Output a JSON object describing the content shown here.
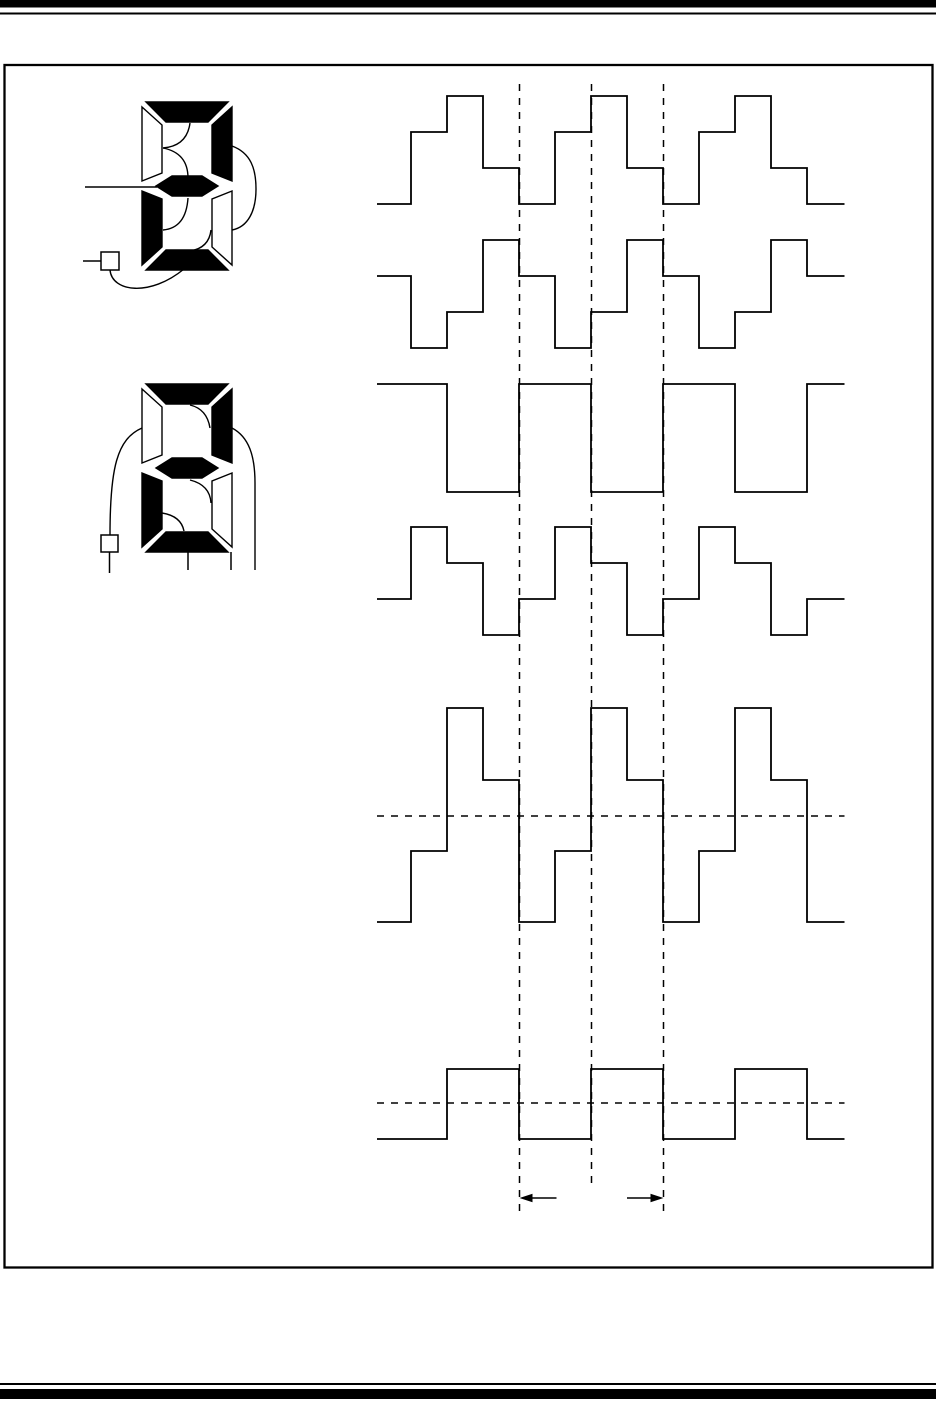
{
  "page": {
    "width": 936,
    "height": 1412,
    "paper_color": "#ffffff",
    "ink_color": "#000000"
  },
  "page_rules": {
    "top_thick_bar": {
      "x": 0,
      "y": 0,
      "w": 936,
      "h": 7.5
    },
    "top_thin_line": {
      "x": 0,
      "y": 12.5,
      "w": 936,
      "h": 2
    },
    "frame": {
      "x": 4.5,
      "y": 65,
      "w": 928,
      "h": 1202.5,
      "stroke_width": 2.3
    },
    "bottom_thin_line": {
      "x": 0,
      "y": 1383,
      "w": 936,
      "h": 2
    },
    "bottom_thick_bar": {
      "x": 0,
      "y": 1389,
      "w": 936,
      "h": 10
    }
  },
  "figure": {
    "displays": [
      {
        "name": "seven-segment-display-top",
        "x": 142,
        "y": 102,
        "w": 90,
        "h": 168,
        "digit_shown": "2",
        "on_segments": [
          "a",
          "b",
          "g",
          "e",
          "d"
        ],
        "off_segments": [
          "f",
          "c"
        ],
        "wires": [
          {
            "name": "wire-a-to-f",
            "d": "M 190 123 Q 187 146 163 148"
          },
          {
            "name": "wire-f-to-g",
            "d": "M 163 148 Q 188 153 188 178"
          },
          {
            "name": "wire-g-to-e",
            "d": "M 188 198 Q 186 228 163 230"
          },
          {
            "name": "wire-c-to-d",
            "d": "M 211 230 Q 209 248 190 251"
          },
          {
            "name": "wire-b-to-c",
            "d": "M 232 146 C 251 153 256 169 256 189 C 256 211 248 227 232 230"
          },
          {
            "name": "wire-square-to-d",
            "d": "M 110 270 C 112 292 150 297 184 269"
          }
        ],
        "leads": [
          {
            "name": "lead-to-segment-g",
            "x1": 85,
            "y1": 187,
            "x2": 157,
            "y2": 187
          },
          {
            "name": "lead-to-terminal",
            "x1": 83,
            "y1": 261,
            "x2": 101,
            "y2": 261
          }
        ],
        "terminal_square": {
          "x": 101,
          "y": 252,
          "w": 18,
          "h": 18
        },
        "drop_lines": []
      },
      {
        "name": "seven-segment-display-bottom",
        "x": 142,
        "y": 384,
        "w": 90,
        "h": 168,
        "digit_shown": "2",
        "on_segments": [
          "a",
          "b",
          "g",
          "e",
          "d"
        ],
        "off_segments": [
          "f",
          "c"
        ],
        "wires": [
          {
            "name": "wire-a-to-b",
            "d": "M 190 405 Q 207 409 210 428"
          },
          {
            "name": "wire-g-to-c",
            "d": "M 190 480 Q 210 485 211 503"
          },
          {
            "name": "wire-e-to-d",
            "d": "M 162 513 Q 181 516 184 531"
          },
          {
            "name": "wire-f-to-terminal",
            "d": "M 142 428 C 117 439 110 468 110 535"
          },
          {
            "name": "wire-b-down-right",
            "d": "M 232 428 C 249 437 255 456 255 483 L 255 570"
          }
        ],
        "leads": [],
        "terminal_square": {
          "x": 101,
          "y": 535,
          "w": 17,
          "h": 17
        },
        "drop_lines": [
          {
            "name": "terminal-drop-line",
            "x1": 109.5,
            "y1": 552,
            "x2": 109.5,
            "y2": 573
          },
          {
            "name": "segment-d-drop-line",
            "x1": 188,
            "y1": 552,
            "x2": 188,
            "y2": 570
          },
          {
            "name": "segment-c-drop-line",
            "x1": 231,
            "y1": 552,
            "x2": 231,
            "y2": 570
          }
        ]
      }
    ],
    "waveforms": [
      {
        "name": "waveform-1",
        "x_start": 377,
        "x_end": 844.5,
        "start": 0,
        "levels_y": [
          204,
          168,
          132,
          96
        ],
        "steps": [
          [
            411,
            2
          ],
          [
            447,
            3
          ],
          [
            483,
            1
          ],
          [
            519,
            0
          ],
          [
            555,
            2
          ],
          [
            591,
            3
          ],
          [
            627,
            1
          ],
          [
            663,
            0
          ],
          [
            699,
            2
          ],
          [
            735,
            3
          ],
          [
            771,
            1
          ],
          [
            807,
            0
          ]
        ]
      },
      {
        "name": "waveform-2",
        "x_start": 377,
        "x_end": 844.5,
        "start": 2,
        "levels_y": [
          348,
          312,
          276,
          240
        ],
        "steps": [
          [
            411,
            0
          ],
          [
            447,
            1
          ],
          [
            483,
            3
          ],
          [
            519,
            2
          ],
          [
            555,
            0
          ],
          [
            591,
            1
          ],
          [
            627,
            3
          ],
          [
            663,
            2
          ],
          [
            699,
            0
          ],
          [
            735,
            1
          ],
          [
            771,
            3
          ],
          [
            807,
            2
          ]
        ]
      },
      {
        "name": "waveform-3",
        "x_start": 377,
        "x_end": 844.5,
        "start": 1,
        "levels_y": [
          492,
          384
        ],
        "steps": [
          [
            447,
            0
          ],
          [
            519,
            1
          ],
          [
            591,
            0
          ],
          [
            663,
            1
          ],
          [
            735,
            0
          ],
          [
            807,
            1
          ]
        ]
      },
      {
        "name": "waveform-4",
        "x_start": 377,
        "x_end": 844.5,
        "start": 1,
        "levels_y": [
          635,
          599,
          563,
          527
        ],
        "steps": [
          [
            411,
            3
          ],
          [
            447,
            2
          ],
          [
            483,
            0
          ],
          [
            519,
            1
          ],
          [
            555,
            3
          ],
          [
            591,
            2
          ],
          [
            627,
            0
          ],
          [
            663,
            1
          ],
          [
            699,
            3
          ],
          [
            735,
            2
          ],
          [
            771,
            0
          ],
          [
            807,
            1
          ]
        ]
      },
      {
        "name": "waveform-5",
        "x_start": 377,
        "x_end": 844.5,
        "start": 0,
        "levels_y": [
          922,
          851,
          780,
          708
        ],
        "zero_line_y": 816,
        "steps": [
          [
            411,
            1
          ],
          [
            447,
            3
          ],
          [
            483,
            2
          ],
          [
            519,
            0
          ],
          [
            555,
            1
          ],
          [
            591,
            3
          ],
          [
            627,
            2
          ],
          [
            663,
            0
          ],
          [
            699,
            1
          ],
          [
            735,
            3
          ],
          [
            771,
            2
          ],
          [
            807,
            0
          ]
        ]
      },
      {
        "name": "waveform-6",
        "x_start": 377,
        "x_end": 844.5,
        "start": 0,
        "levels_y": [
          1139,
          1069
        ],
        "zero_line_y": 1103,
        "steps": [
          [
            447,
            1
          ],
          [
            519,
            0
          ],
          [
            591,
            1
          ],
          [
            663,
            0
          ],
          [
            735,
            1
          ],
          [
            807,
            0
          ]
        ]
      }
    ],
    "dashed_vertical_lines": [
      {
        "name": "timing-line-1",
        "x": 519.5,
        "y1": 84,
        "y2": 1212
      },
      {
        "name": "timing-line-2",
        "x": 591.5,
        "y1": 84,
        "y2": 1185
      },
      {
        "name": "timing-line-3",
        "x": 663.5,
        "y1": 84,
        "y2": 1212
      }
    ],
    "dimension_arrows": {
      "y": 1198,
      "left": {
        "tip_x": 519.5,
        "tail_x": 556.5
      },
      "right": {
        "tip_x": 663.5,
        "tail_x": 627
      }
    }
  },
  "chart_data": {
    "type": "timing",
    "title": "",
    "x_slot_px": 36,
    "period_px": 144,
    "marked_interval_x": [
      519.5,
      663.5
    ],
    "rows": [
      {
        "name": "waveform-1",
        "num_levels": 4,
        "sequence_per_slot": [
          0,
          2,
          3,
          1
        ]
      },
      {
        "name": "waveform-2",
        "num_levels": 4,
        "sequence_per_slot": [
          2,
          0,
          1,
          3
        ]
      },
      {
        "name": "waveform-3",
        "num_levels": 2,
        "sequence_per_slot": [
          1,
          1,
          0,
          0
        ]
      },
      {
        "name": "waveform-4",
        "num_levels": 4,
        "sequence_per_slot": [
          1,
          3,
          2,
          0
        ]
      },
      {
        "name": "waveform-5",
        "num_levels": 4,
        "levels": [
          -3,
          -1,
          1,
          3
        ],
        "sequence_per_slot": [
          -3,
          -1,
          3,
          1
        ],
        "zero_dashed_line": true
      },
      {
        "name": "waveform-6",
        "num_levels": 2,
        "levels": [
          -1,
          1
        ],
        "sequence_per_slot": [
          -1,
          -1,
          1,
          1
        ],
        "zero_dashed_line": true
      }
    ]
  }
}
